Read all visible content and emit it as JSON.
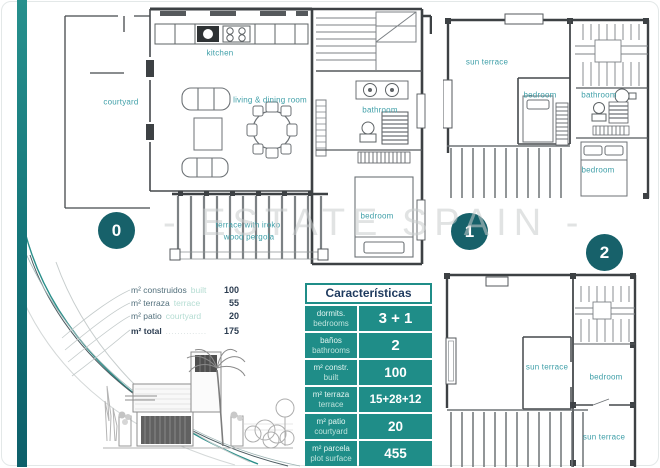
{
  "page": {
    "watermark": "- ESTATE SPAIN -"
  },
  "colors": {
    "table_teal": "#1f8d88",
    "badge_teal": "#17616a",
    "room_label_teal": "#3f9fa8"
  },
  "plans": {
    "ground": {
      "number": "0",
      "rooms": {
        "kitchen": "kitchen",
        "courtyard": "courtyard",
        "living": "living & dining room",
        "bathroom": "bathroom",
        "bedroom": "bedroom",
        "terrace_line1": "terrace with iroko",
        "terrace_line2": "wood pergola"
      }
    },
    "first": {
      "number": "1",
      "rooms": {
        "sun_terrace": "sun terrace",
        "bedroom_left": "bedroom",
        "bathroom": "bathroom",
        "bedroom_right": "bedroom"
      }
    },
    "second": {
      "number": "2",
      "rooms": {
        "sun_terrace_mid": "sun terrace",
        "bedroom": "bedroom",
        "sun_terrace_bottom": "sun terrace"
      }
    }
  },
  "measurements": {
    "rows": [
      {
        "label": "m² construidos",
        "label_en": "built",
        "value": "100"
      },
      {
        "label": "m² terraza",
        "label_en": "terrace",
        "value": "55"
      },
      {
        "label": "m² patio",
        "label_en": "courtyard",
        "value": "20"
      },
      {
        "label": "m² total",
        "label_en": "..............",
        "value": "175"
      }
    ]
  },
  "table": {
    "title": "Características",
    "rows": [
      {
        "label_es": "dormits.",
        "label_en": "bedrooms",
        "value": "3 + 1"
      },
      {
        "label_es": "baños",
        "label_en": "bathrooms",
        "value": "2"
      },
      {
        "label_es": "m² constr.",
        "label_en": "built",
        "value": "100"
      },
      {
        "label_es": "m² terraza",
        "label_en": "terrace",
        "value": "15+28+12"
      },
      {
        "label_es": "m² patio",
        "label_en": "courtyard",
        "value": "20"
      },
      {
        "label_es": "m² parcela",
        "label_en": "plot surface",
        "value": "455"
      }
    ]
  }
}
